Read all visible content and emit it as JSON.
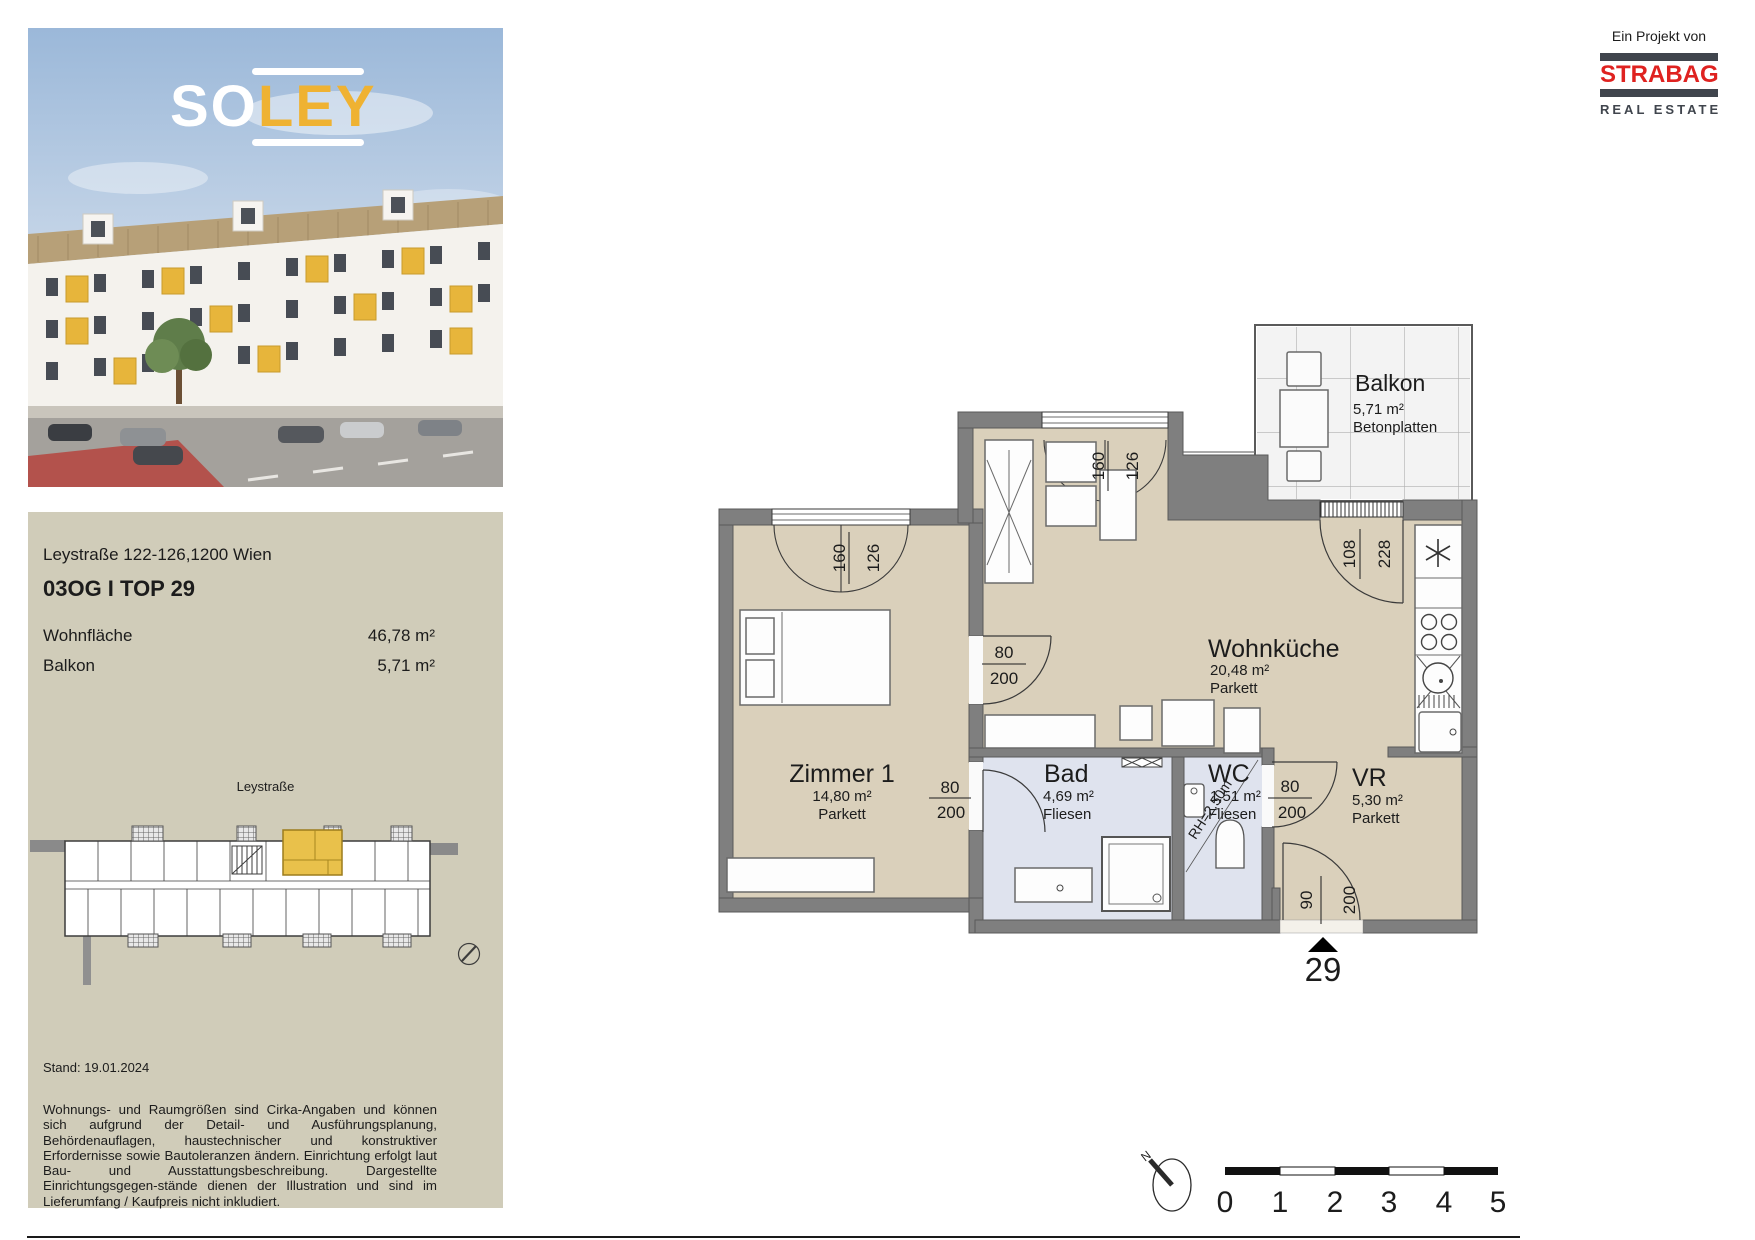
{
  "project": {
    "attribution": "Ein Projekt von",
    "brand": "STRABAG",
    "brand_sub": "REAL ESTATE"
  },
  "logo": {
    "part1": "SO",
    "part2": "LEY"
  },
  "info": {
    "address": "Leystraße 122-126,1200 Wien",
    "unit_title": "03OG I TOP 29",
    "rows": [
      {
        "label": "Wohnfläche",
        "value": "46,78 m²"
      },
      {
        "label": "Balkon",
        "value": "5,71 m²"
      }
    ],
    "sitemap_street": "Leystraße",
    "stand": "Stand: 19.01.2024",
    "disclaimer": "Wohnungs- und Raumgrößen sind Cirka-Angaben und können sich aufgrund der Detail- und Ausführungsplanung, Behördenauflagen, haustechnischer und konstruktiver Erfordernisse sowie Bautoleranzen ändern. Einrichtung erfolgt laut Bau- und Ausstattungsbeschreibung. Dargestellte Einrichtungsgegen-stände dienen der Illustration und sind im Lieferumfang / Kaufpreis nicht inkludiert."
  },
  "plan": {
    "rooms": {
      "balkon": {
        "name": "Balkon",
        "area": "5,71 m²",
        "floor": "Betonplatten"
      },
      "wohnkueche": {
        "name": "Wohnküche",
        "area": "20,48 m²",
        "floor": "Parkett"
      },
      "zimmer1": {
        "name": "Zimmer 1",
        "area": "14,80 m²",
        "floor": "Parkett"
      },
      "bad": {
        "name": "Bad",
        "area": "4,69 m²",
        "floor": "Fliesen"
      },
      "wc": {
        "name": "WC",
        "area": "1,51 m²",
        "floor": "Fliesen"
      },
      "vr": {
        "name": "VR",
        "area": "5,30 m²",
        "floor": "Parkett"
      }
    },
    "dims": {
      "z1_window_w": "160",
      "z1_window_h": "126",
      "nook_window_w": "160",
      "nook_window_h": "126",
      "wk_door_w": "80",
      "wk_door_h": "200",
      "z1_door_w": "80",
      "z1_door_h": "200",
      "wc_door_w": "80",
      "wc_door_h": "200",
      "balcony_door_w": "108",
      "balcony_door_h": "228",
      "entrance_w": "90",
      "entrance_h": "200"
    },
    "rh_note": "RH=2,50m",
    "unit_number": "29",
    "north_label": "N",
    "scale_ticks": [
      "0",
      "1",
      "2",
      "3",
      "4",
      "5"
    ]
  },
  "colors": {
    "highlight_yellow": "#e9c14b",
    "soley_yellow": "#efb232",
    "strabag_red": "#df2220",
    "panel_beige": "#d0ccb9",
    "floor_parkett": "#dad0bb",
    "floor_fliesen": "#dfe3ee",
    "wall_gray": "#7f7f7f"
  }
}
